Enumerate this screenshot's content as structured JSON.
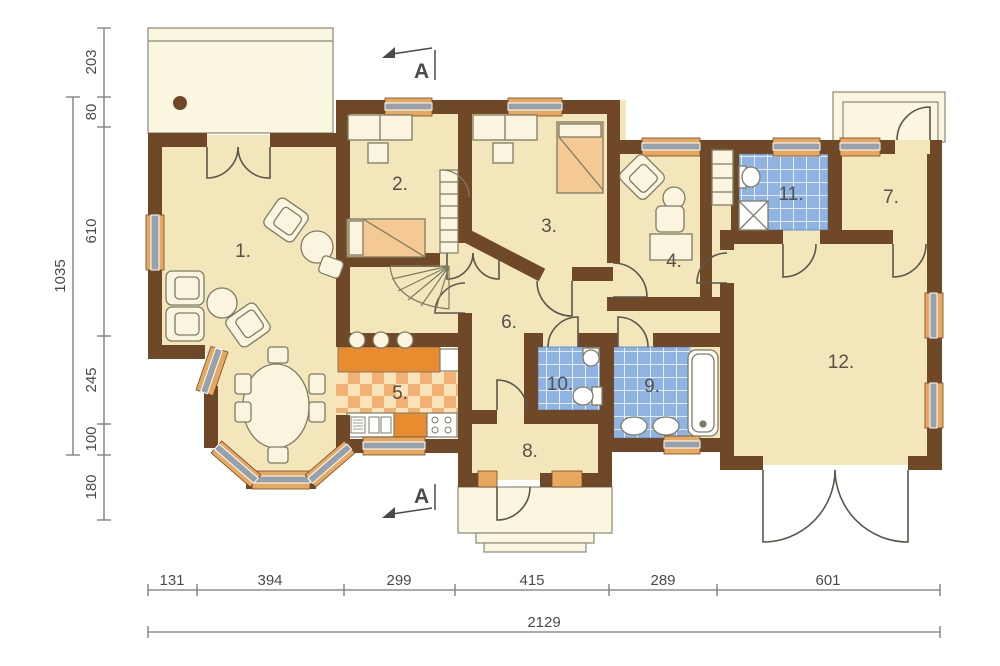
{
  "title": "house-ground-floor-plan",
  "rooms": [
    "1.",
    "2.",
    "3.",
    "4.",
    "5.",
    "6.",
    "7.",
    "8.",
    "9.",
    "10.",
    "11.",
    "12."
  ],
  "dims": {
    "left": [
      "203",
      "80",
      "610",
      "245",
      "100",
      "180"
    ],
    "left_total": "1035",
    "bottom": [
      "131",
      "394",
      "299",
      "415",
      "289",
      "601"
    ],
    "bottom_total": "2129"
  },
  "section": {
    "top": "A",
    "bottom": "A"
  },
  "colors": {
    "wall": "#6F4827",
    "floor": "#F4E6BB",
    "porch": "#FBF6E0",
    "tile_blue": "#8FB4E4",
    "kitchen_orange": "#E98B2F",
    "window_sill": "#E8A95E",
    "window_glass": "#95A1AD",
    "bed_orange": "#F5C993",
    "line": "#7D7C64",
    "dim_line": "#777777"
  }
}
